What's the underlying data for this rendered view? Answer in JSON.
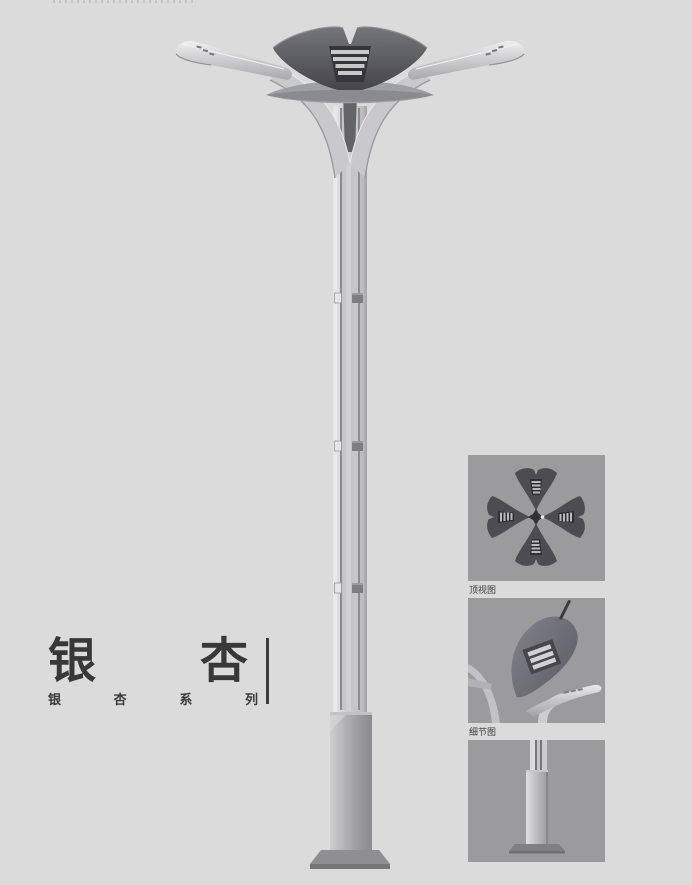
{
  "page": {
    "background": "#dbdbdb",
    "description": "Street lamp product catalog page, Ginkgo series"
  },
  "title": {
    "main_chars": [
      "银",
      "杏"
    ],
    "series_chars": [
      "银",
      "杏",
      "系",
      "列"
    ],
    "series_text": "银杏系列",
    "text_color": "#383838"
  },
  "panels": [
    {
      "caption": "顶视图"
    },
    {
      "caption": "细节图"
    },
    {
      "caption": ""
    }
  ],
  "illustration": {
    "subject": "double-arm ginkgo-leaf street lamp pole",
    "colors": {
      "panel_bg": "#9b9b9d",
      "dark_metal": "#46464c",
      "mid_metal": "#8c8c92",
      "light_metal": "#cdcdcf",
      "pole_highlight": "#e6e6e8",
      "base_metal": "#8e8e92",
      "text": "#383838"
    }
  }
}
